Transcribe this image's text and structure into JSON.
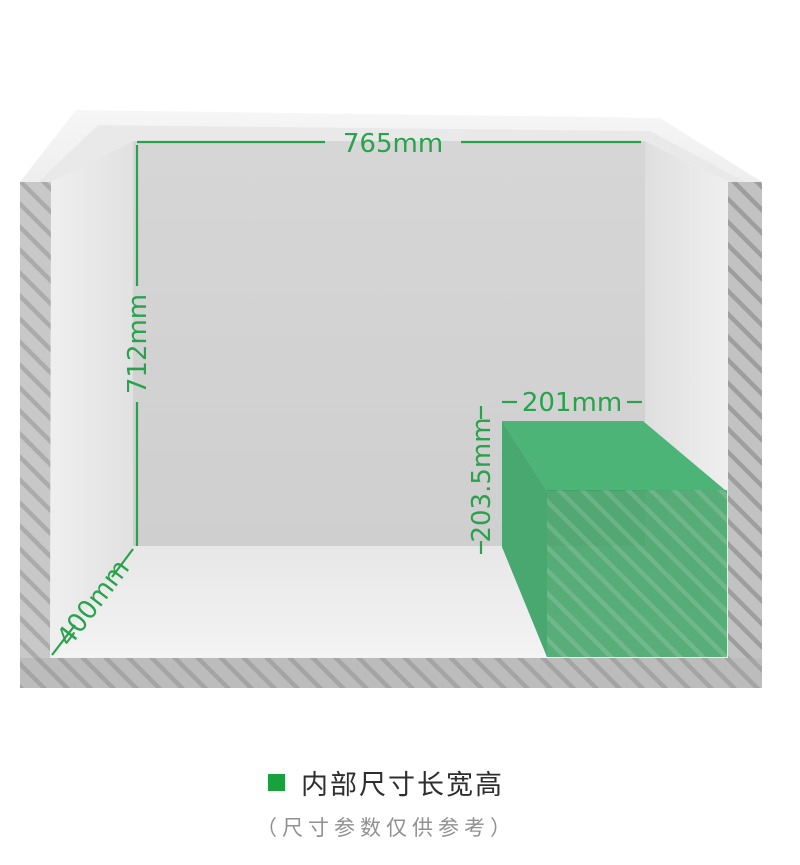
{
  "labels": {
    "width": "765mm",
    "height": "712mm",
    "depth": "400mm",
    "box_width": "201mm",
    "box_height": "203.5mm"
  },
  "colors": {
    "dimension_green": "#28a34c",
    "box_top_face": "#4cb476",
    "box_left_face": "#49a770",
    "box_front_face": "#379f5e",
    "caption_bullet_green": "#18a23e"
  },
  "caption": {
    "title": "内部尺寸长宽高",
    "subtitle": "（尺寸参数仅供参考）"
  }
}
